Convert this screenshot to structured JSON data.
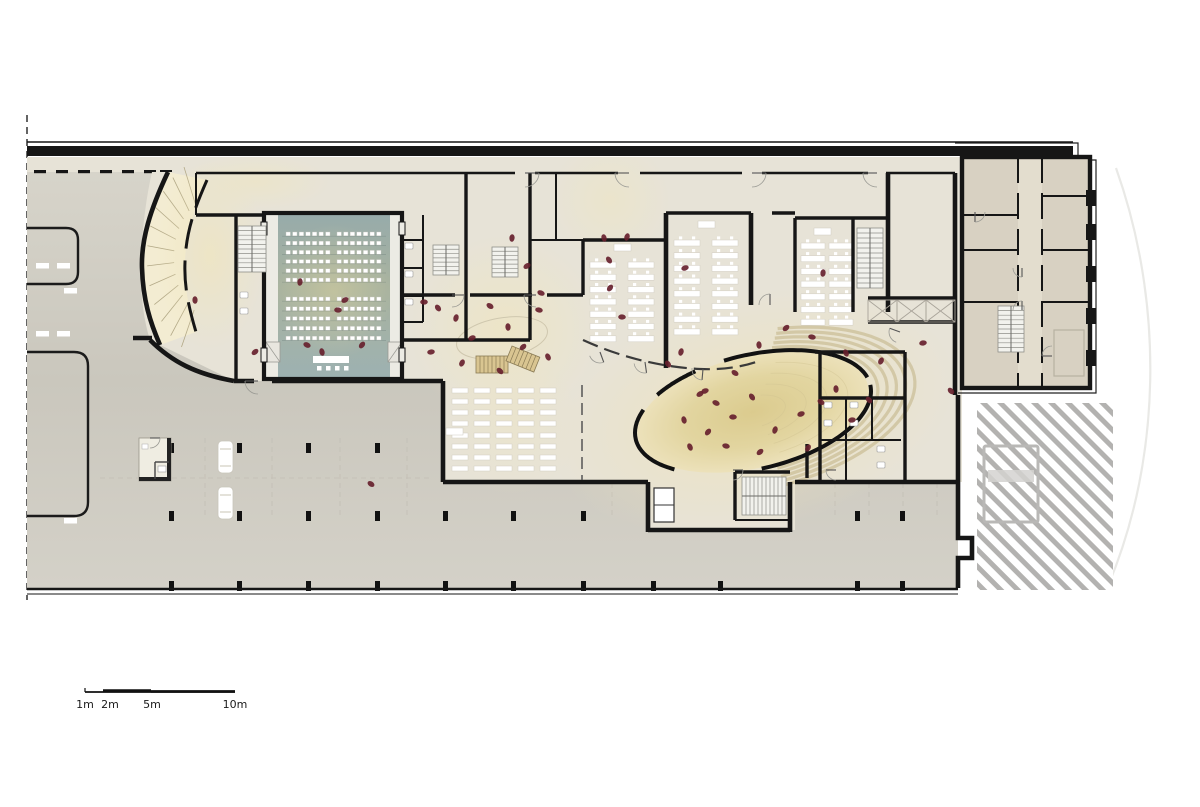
{
  "meta": {
    "title": "Ground floor architectural plan",
    "kind": "floor-plan"
  },
  "colors": {
    "wall": "#161616",
    "floor": "#e7e3d7",
    "wing_floor": "#d8d1c2",
    "wing_corridor": "#e3ddce",
    "paving": "#cfccc2",
    "entry_yellow": "#f3ecd2",
    "glow_yellow": "#f1e6bf",
    "auditorium_top": "#97abaa",
    "auditorium_mid": "#a9b39f",
    "auditorium_low": "#9db1b1",
    "aisle": "#ecebe4",
    "amphitheater_center": "#dccd92",
    "amphitheater_edge": "#ece1ba",
    "amphitheater_step": "#c9bc94",
    "people": "#67212e",
    "hatch_stripe": "#b3b2b0",
    "stair_wood": "#d9c591",
    "car": "#ffffff"
  },
  "scale_bar": {
    "labels": [
      "1m",
      "2m",
      "5m",
      "10m"
    ],
    "x": 85,
    "y": 692,
    "length": 150,
    "label_offsets": [
      0,
      18,
      66,
      148
    ]
  },
  "plan": {
    "auditorium": {
      "room": [
        264,
        213,
        138,
        166
      ],
      "seat": [
        4.4,
        3.8
      ],
      "blocks": [
        {
          "x0": 286,
          "n": 7,
          "dx": 6.6
        },
        {
          "x0": 337,
          "n": 7,
          "dx": 6.6
        }
      ],
      "groups": [
        {
          "y0": 232,
          "n": 6,
          "dy": 9.2
        },
        {
          "y0": 297,
          "n": 5,
          "dy": 9.8
        }
      ],
      "stage": [
        313,
        356,
        36,
        7
      ],
      "stage_chairs": [
        [
          317,
          366
        ],
        [
          326,
          366
        ],
        [
          335,
          366
        ],
        [
          344,
          366
        ]
      ]
    },
    "classrooms": [
      {
        "cols": [
          590,
          628
        ],
        "desk": [
          26,
          6
        ],
        "chairs": true,
        "groups": [
          {
            "y0": 262,
            "n": 7,
            "dy": 12.3
          }
        ],
        "teacher": [
          614,
          244
        ]
      },
      {
        "cols": [
          674,
          712
        ],
        "desk": [
          26,
          6
        ],
        "chairs": true,
        "groups": [
          {
            "y0": 240,
            "n": 8,
            "dy": 12.7
          }
        ],
        "teacher": [
          698,
          221
        ]
      },
      {
        "cols": [
          801,
          829
        ],
        "desk": [
          24,
          6
        ],
        "chairs": true,
        "groups": [
          {
            "y0": 243,
            "n": 7,
            "dy": 12.7
          }
        ],
        "teacher": [
          814,
          228
        ]
      },
      {
        "cols": [
          452,
          474,
          496,
          518,
          540
        ],
        "desk": [
          16,
          5
        ],
        "chairs": false,
        "groups": [
          {
            "y0": 388,
            "n": 4,
            "dy": 11
          },
          {
            "y0": 433,
            "n": 4,
            "dy": 11
          }
        ],
        "teacher": [
          446,
          428
        ]
      }
    ],
    "amphitheater": {
      "cx": 753,
      "cy": 412,
      "rx": 118,
      "ry": 56,
      "rot": -13,
      "wall_arcs": [
        [
          138,
          208
        ],
        [
          222,
          247
        ],
        [
          262,
          352
        ],
        [
          0,
          92
        ]
      ],
      "step_scales": [
        1.08,
        1.16,
        1.24,
        1.32,
        1.4
      ],
      "step_arc": [
        -75,
        85
      ]
    },
    "parking": {
      "columns": [
        [
          169,
          443
        ],
        [
          237,
          443
        ],
        [
          306,
          443
        ],
        [
          375,
          443
        ],
        [
          169,
          511
        ],
        [
          237,
          511
        ],
        [
          306,
          511
        ],
        [
          375,
          511
        ],
        [
          443,
          511
        ],
        [
          511,
          511
        ],
        [
          581,
          511
        ],
        [
          648,
          511
        ],
        [
          855,
          511
        ],
        [
          900,
          511
        ],
        [
          169,
          581
        ],
        [
          237,
          581
        ],
        [
          306,
          581
        ],
        [
          375,
          581
        ],
        [
          443,
          581
        ],
        [
          511,
          581
        ],
        [
          581,
          581
        ],
        [
          651,
          581
        ],
        [
          718,
          581
        ],
        [
          855,
          581
        ],
        [
          900,
          581
        ]
      ],
      "grid_x": [
        205,
        272,
        340,
        407,
        612,
        680,
        835,
        869,
        903,
        937
      ],
      "stall_marks": [
        [
          36,
          263
        ],
        [
          57,
          263
        ],
        [
          64,
          288
        ],
        [
          36,
          331
        ],
        [
          57,
          331
        ],
        [
          64,
          518
        ]
      ],
      "cars": [
        [
          218,
          441
        ],
        [
          218,
          487
        ]
      ],
      "dropoff_dashes": [
        34,
        56,
        78,
        100,
        122,
        144,
        160
      ]
    },
    "stairs": [
      {
        "x": 238,
        "y": 226,
        "w": 28,
        "h": 46,
        "dir": "h",
        "n": 10
      },
      {
        "x": 433,
        "y": 245,
        "w": 26,
        "h": 30,
        "dir": "h",
        "n": 7
      },
      {
        "x": 492,
        "y": 247,
        "w": 26,
        "h": 30,
        "dir": "h",
        "n": 7
      },
      {
        "x": 857,
        "y": 228,
        "w": 26,
        "h": 60,
        "dir": "h",
        "n": 12
      },
      {
        "x": 998,
        "y": 306,
        "w": 26,
        "h": 46,
        "dir": "h",
        "n": 10
      },
      {
        "x": 742,
        "y": 477,
        "w": 44,
        "h": 38,
        "dir": "v",
        "n": 11
      },
      {
        "x": 476,
        "y": 356,
        "w": 32,
        "h": 17,
        "dir": "v",
        "n": 8,
        "wood": true
      },
      {
        "x": 512,
        "y": 346,
        "w": 30,
        "h": 16,
        "dir": "v",
        "n": 7,
        "wood": true,
        "rot": 22
      }
    ],
    "doors": [
      [
        525,
        173,
        14,
        0,
        1
      ],
      [
        629,
        173,
        14,
        180,
        -1
      ],
      [
        752,
        173,
        14,
        0,
        1
      ],
      [
        877,
        173,
        14,
        180,
        -1
      ],
      [
        258,
        381,
        13,
        180,
        -1
      ],
      [
        452,
        295,
        12,
        0,
        1
      ],
      [
        536,
        295,
        12,
        180,
        -1
      ],
      [
        600,
        352,
        11,
        70,
        1
      ],
      [
        645,
        362,
        11,
        82,
        1
      ],
      [
        703,
        369,
        11,
        95,
        1
      ],
      [
        770,
        305,
        11,
        270,
        -1
      ],
      [
        900,
        332,
        11,
        200,
        -1
      ],
      [
        836,
        470,
        10,
        180,
        -1
      ],
      [
        733,
        470,
        10,
        0,
        1
      ],
      [
        150,
        438,
        10,
        0,
        1
      ],
      [
        1022,
        268,
        9,
        90,
        1
      ],
      [
        1022,
        310,
        9,
        270,
        -1
      ],
      [
        975,
        212,
        10,
        90,
        -1
      ],
      [
        1052,
        356,
        10,
        180,
        1
      ]
    ],
    "people": [
      [
        424,
        302
      ],
      [
        438,
        308
      ],
      [
        456,
        318
      ],
      [
        472,
        338
      ],
      [
        490,
        306
      ],
      [
        508,
        327
      ],
      [
        523,
        347
      ],
      [
        539,
        310
      ],
      [
        548,
        357
      ],
      [
        462,
        363
      ],
      [
        431,
        352
      ],
      [
        500,
        371
      ],
      [
        512,
        238
      ],
      [
        527,
        266
      ],
      [
        541,
        293
      ],
      [
        604,
        238
      ],
      [
        610,
        288
      ],
      [
        622,
        317
      ],
      [
        668,
        364
      ],
      [
        681,
        352
      ],
      [
        705,
        391
      ],
      [
        735,
        373
      ],
      [
        759,
        345
      ],
      [
        786,
        328
      ],
      [
        812,
        337
      ],
      [
        846,
        353
      ],
      [
        881,
        361
      ],
      [
        923,
        343
      ],
      [
        951,
        391
      ],
      [
        823,
        273
      ],
      [
        700,
        394
      ],
      [
        716,
        403
      ],
      [
        684,
        420
      ],
      [
        708,
        432
      ],
      [
        733,
        417
      ],
      [
        752,
        397
      ],
      [
        775,
        430
      ],
      [
        801,
        414
      ],
      [
        821,
        402
      ],
      [
        836,
        389
      ],
      [
        760,
        452
      ],
      [
        726,
        446
      ],
      [
        690,
        447
      ],
      [
        808,
        448
      ],
      [
        852,
        420
      ],
      [
        869,
        400
      ],
      [
        300,
        282
      ],
      [
        345,
        300
      ],
      [
        307,
        345
      ],
      [
        322,
        352
      ],
      [
        362,
        345
      ],
      [
        338,
        310
      ],
      [
        609,
        260
      ],
      [
        627,
        237
      ],
      [
        685,
        268
      ],
      [
        371,
        484
      ],
      [
        195,
        300
      ],
      [
        255,
        352
      ]
    ]
  }
}
